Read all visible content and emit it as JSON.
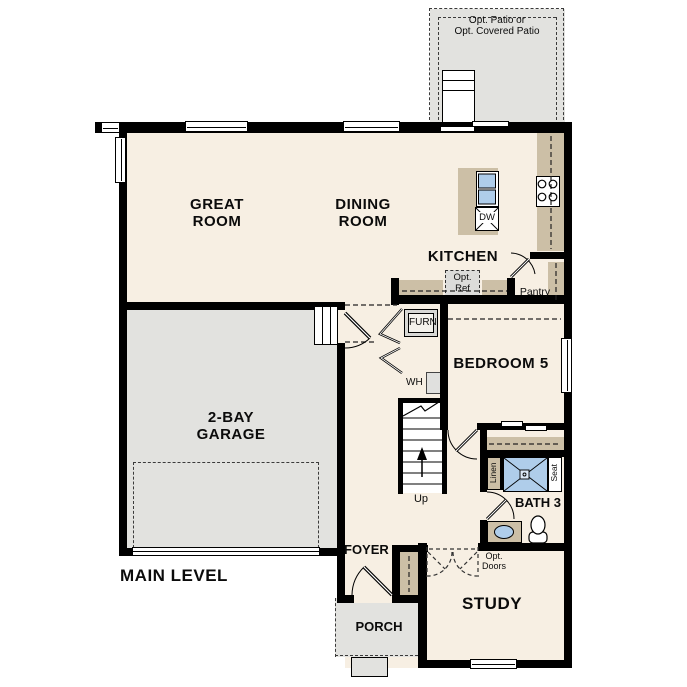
{
  "plan": {
    "title": "MAIN LEVEL",
    "rooms": {
      "great_room": {
        "l1": "GREAT",
        "l2": "ROOM"
      },
      "dining_room": {
        "l1": "DINING",
        "l2": "ROOM"
      },
      "kitchen": {
        "label": "KITCHEN"
      },
      "garage": {
        "l1": "2-BAY",
        "l2": "GARAGE"
      },
      "bedroom5": {
        "label": "BEDROOM 5"
      },
      "bath3": {
        "label": "BATH 3"
      },
      "foyer": {
        "label": "FOYER"
      },
      "porch": {
        "label": "PORCH"
      },
      "study": {
        "label": "STUDY"
      },
      "pantry": {
        "label": "Pantry"
      }
    },
    "features": {
      "opt_patio": {
        "l1": "Opt. Patio or",
        "l2": "Opt. Covered Patio"
      },
      "opt_ref": {
        "l1": "Opt.",
        "l2": "Ref"
      },
      "opt_doors": {
        "l1": "Opt.",
        "l2": "Doors"
      },
      "furnace": "FURN",
      "water_heater": "WH",
      "dishwasher": "DW",
      "stairs_up": "Up",
      "linen": "Linen",
      "seat": "Seat"
    },
    "colors": {
      "floor": "#f7efe3",
      "concrete": "#e2e2df",
      "cabinet": "#ccbfa6",
      "water": "#afcdea",
      "wall": "#000000"
    }
  }
}
